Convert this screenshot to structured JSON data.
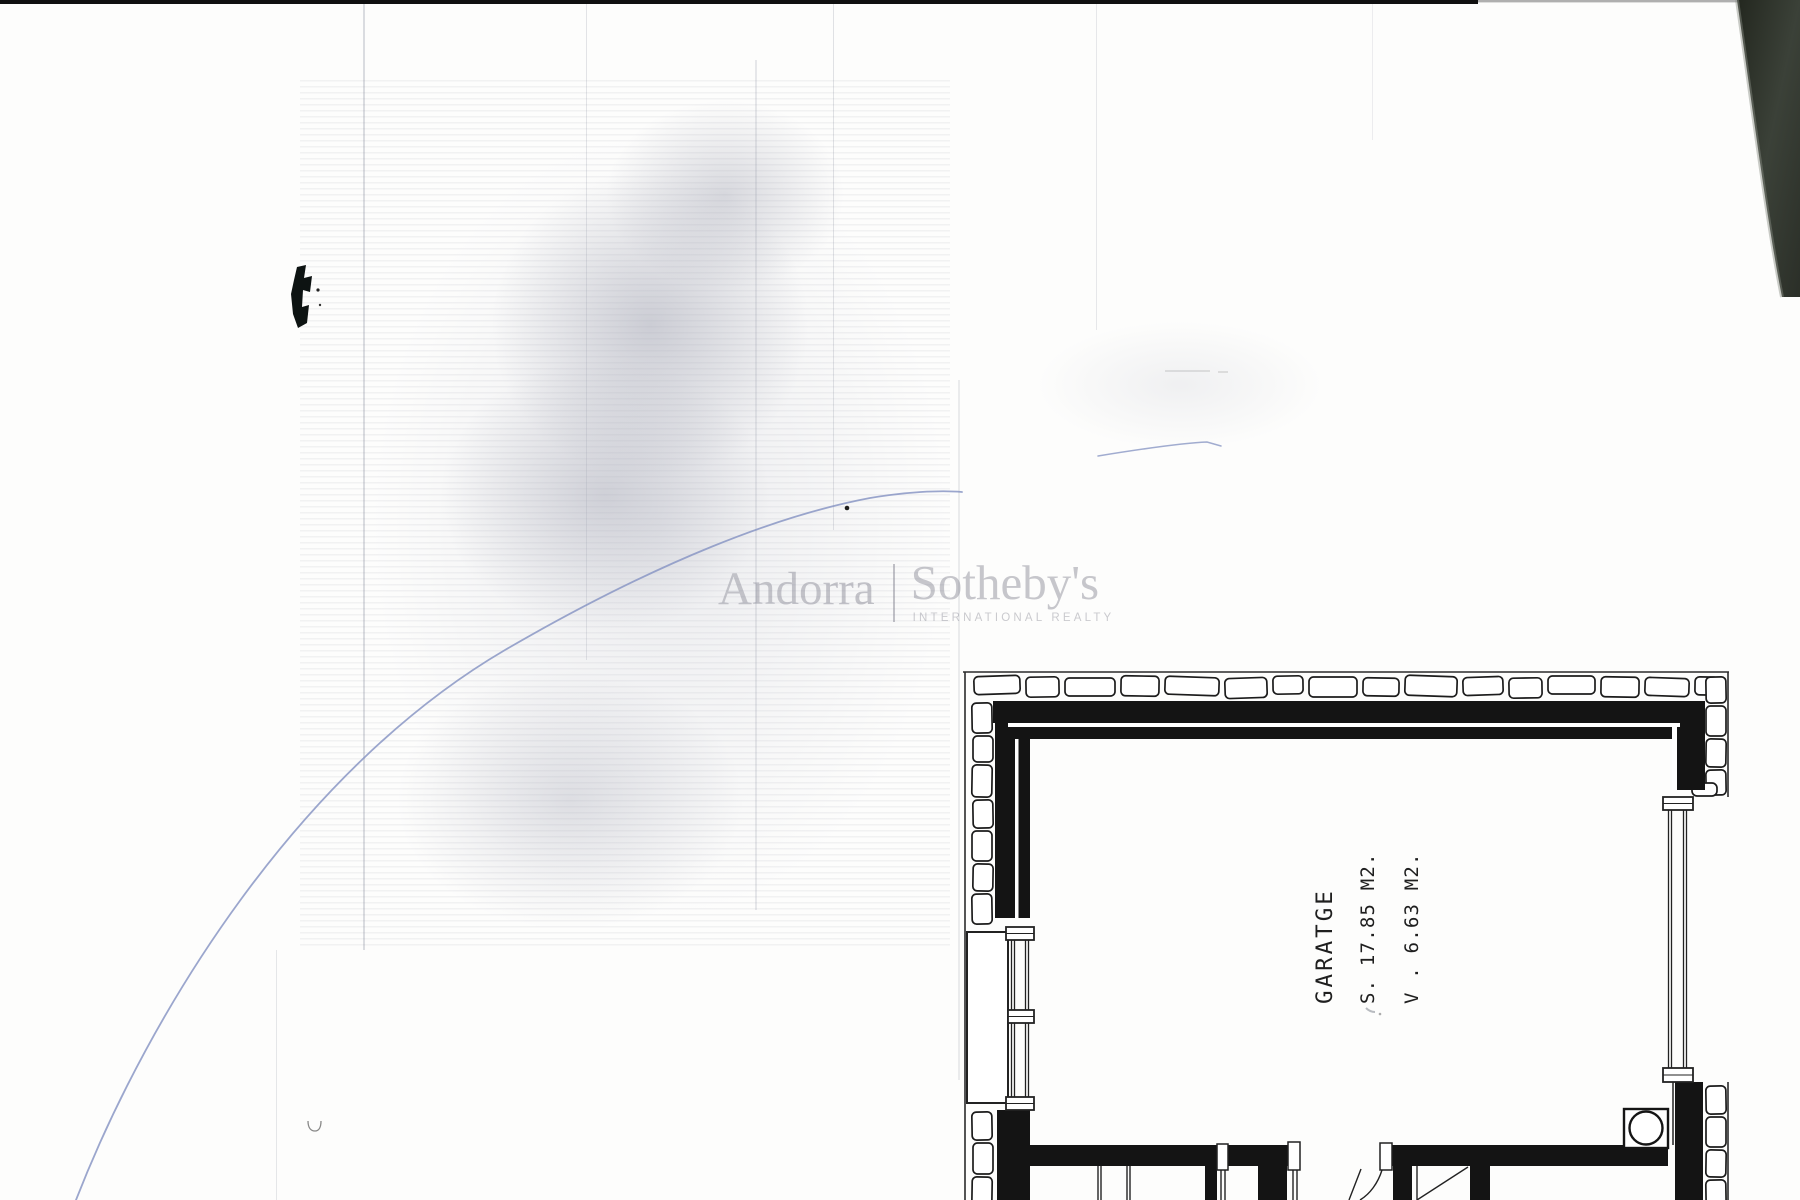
{
  "watermark": {
    "left": "Andorra",
    "right": "Sotheby's",
    "subtitle": "INTERNATIONAL REALTY"
  },
  "room": {
    "name": "GARATGE",
    "area": "S. 17.85 M2.",
    "volume": "V . 6.63 M2."
  },
  "colors": {
    "ink": "#141414",
    "outline": "#2b2b2b",
    "watermark_gray": "#c6c6cb",
    "pen_blue": "#8a97c4",
    "smudge_gray": "#a9abb8"
  }
}
